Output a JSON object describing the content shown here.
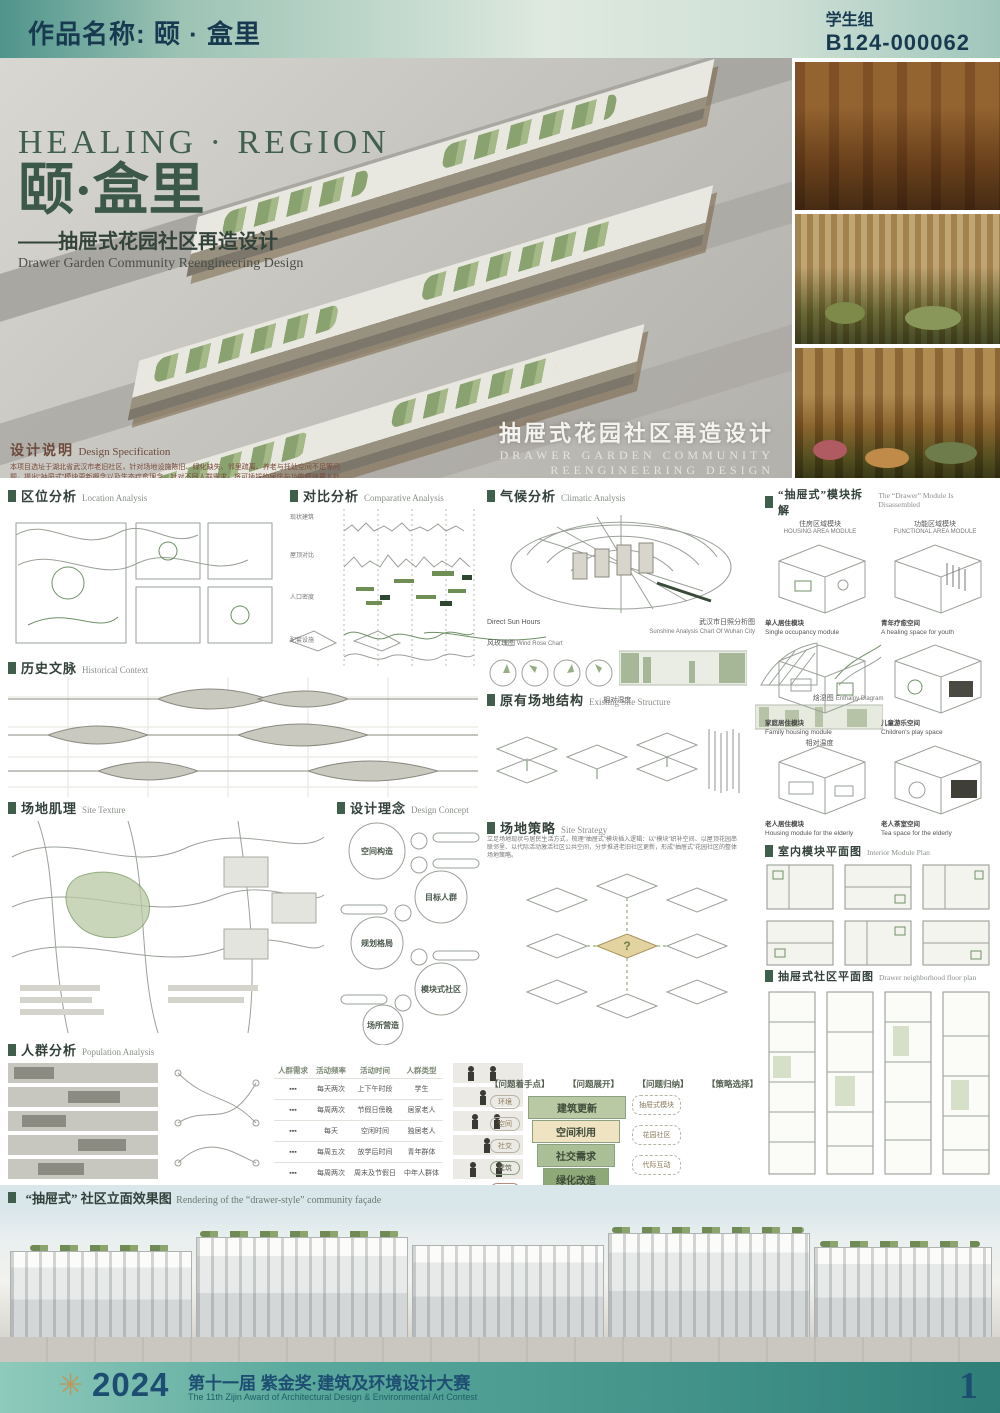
{
  "header": {
    "work_label": "作品名称: 颐 · 盒里",
    "group_label": "学生组",
    "entry_code": "B124-000062"
  },
  "hero": {
    "title_en": "HEALING · REGION",
    "title_cn": "颐·盒里",
    "subtitle_cn": "——抽屉式花园社区再造设计",
    "subtitle_en": "Drawer Garden Community Reengineering Design",
    "spec_label_cn": "设计说明",
    "spec_label_en": "Design Specification",
    "spec_body": "本项目选址于湖北省武汉市老旧社区，针对场地设施陈旧、绿化缺失、邻里疏离、养老与托幼空间不足等问题，提出“抽屉式”模块更新概念以及生态疗愈理念。针对不同人群需求，将可插拔的居住与功能模块置入社区建筑体块中，唤起记忆同时织补生活场景；以屋顶花园串联邻里空间，重塑代际交流场所，缓解老旧社区用地紧张与绿化率低的问题，营造自然疗愈的花园社区，实现老旧社区的活力再生。“抽屉式花园社区”构想展示了老旧社区更新改造的新可能，以富有自然气息的场景，回应了“一老一小”群体对社区交往空间的需求。",
    "overlay_cn": "抽屉式花园社区再造设计",
    "overlay_en1": "DRAWER GARDEN COMMUNITY",
    "overlay_en2": "REENGINEERING DESIGN"
  },
  "sections": {
    "location": {
      "cn": "区位分析",
      "en": "Location Analysis"
    },
    "comparative": {
      "cn": "对比分析",
      "en": "Comparative Analysis"
    },
    "climatic": {
      "cn": "气候分析",
      "en": "Climatic Analysis"
    },
    "disassembly": {
      "cn": "“抽屉式”模块拆解",
      "en": "The “Drawer” Module Is Disassembled"
    },
    "historical": {
      "cn": "历史文脉",
      "en": "Historical Context"
    },
    "existing": {
      "cn": "原有场地结构",
      "en": "Existing Site Structure"
    },
    "texture": {
      "cn": "场地肌理",
      "en": "Site Texture"
    },
    "concept": {
      "cn": "设计理念",
      "en": "Design Concept"
    },
    "strategy": {
      "cn": "场地策略",
      "en": "Site Strategy"
    },
    "interior": {
      "cn": "室内模块平面图",
      "en": "Interior Module Plan"
    },
    "drawer_plan": {
      "cn": "抽屉式社区平面图",
      "en": "Drawer neighborhood floor plan"
    },
    "population": {
      "cn": "人群分析",
      "en": "Population Analysis"
    },
    "facade": {
      "cn": "“抽屉式” 社区立面效果图",
      "en": "Rendering of the “drawer-style” community façade"
    }
  },
  "modules": {
    "housing_cn": "住房区域模块",
    "housing_en": "HOUSING AREA MODULE",
    "functional_cn": "功能区域模块",
    "functional_en": "FUNCTIONAL AREA MODULE",
    "items": [
      {
        "cn": "单人居住模块",
        "en": "Single occupancy module"
      },
      {
        "cn": "青年疗愈空间",
        "en": "A healing space for youth"
      },
      {
        "cn": "家庭居住模块",
        "en": "Family housing module"
      },
      {
        "cn": "儿童游乐空间",
        "en": "Children's play space"
      },
      {
        "cn": "老人居住模块",
        "en": "Housing module for the elderly"
      },
      {
        "cn": "老人茶室空间",
        "en": "Tea space for the elderly"
      }
    ]
  },
  "climate": {
    "sun_label": "Direct Sun Hours",
    "sun_cn": "武汉市日照分析图",
    "sun_en": "Sunshine Analysis Chart Of Wuhan City",
    "rose_cn": "风玫瑰图",
    "rose_en": "Wind Rose Chart",
    "enthalpy_cn": "焓湿图",
    "enthalpy_en": "Enthalpy Diagram",
    "humidity": "相对湿度",
    "temperature": "相对温度"
  },
  "comparative_rows": [
    "现状建筑",
    "屋顶对比",
    "人口密度",
    "配套设施"
  ],
  "concept_circles": [
    "空间构造",
    "目标人群",
    "规划格局",
    "模块式社区",
    "场所营造"
  ],
  "strategy_body": "立足场地现状与居民生活方式，梳理“抽屉式”模块插入逻辑：以“模块”织补空间、以屋顶花园串联邻里、以代际活动激活社区公共空间，分步推进老旧社区更新，形成“抽屉式”花园社区的整体场地策略。",
  "population_table": {
    "headers": [
      "人群需求",
      "活动频率",
      "活动时间",
      "人群类型"
    ],
    "rows": [
      {
        "freq": "每天两次",
        "time": "上下午时段",
        "type": "学生"
      },
      {
        "freq": "每周两次",
        "time": "节假日傍晚",
        "type": "居家老人"
      },
      {
        "freq": "每天",
        "time": "空闲时间",
        "type": "独居老人"
      },
      {
        "freq": "每周五次",
        "time": "放学后时间",
        "type": "青年群体"
      },
      {
        "freq": "每周两次",
        "time": "周末及节假日",
        "type": "中年人群体"
      }
    ]
  },
  "flow": {
    "headers": [
      "【问题着手点】",
      "【问题展开】",
      "【问题归纳】",
      "【策略选择】"
    ],
    "pills": [
      "环境",
      "空间",
      "社交",
      "建筑",
      "疗愈"
    ],
    "funnel": [
      "建筑更新",
      "空间利用",
      "社交需求",
      "绿化改造",
      "代际交流"
    ],
    "outcomes": [
      "抽屉式模块",
      "花园社区",
      "代际互动"
    ]
  },
  "footer": {
    "year": "2024",
    "title_cn": "第十一届 紫金奖·建筑及环境设计大赛",
    "title_en": "The 11th Zijin Award of Architectural Design & Environmental Art Contest",
    "page": "1",
    "logo": "✳"
  },
  "colors": {
    "header_teal": "#4f948c",
    "title_green": "#3c5846",
    "accent_green": "#7e9a63",
    "footer_navy": "#1d4e72"
  }
}
